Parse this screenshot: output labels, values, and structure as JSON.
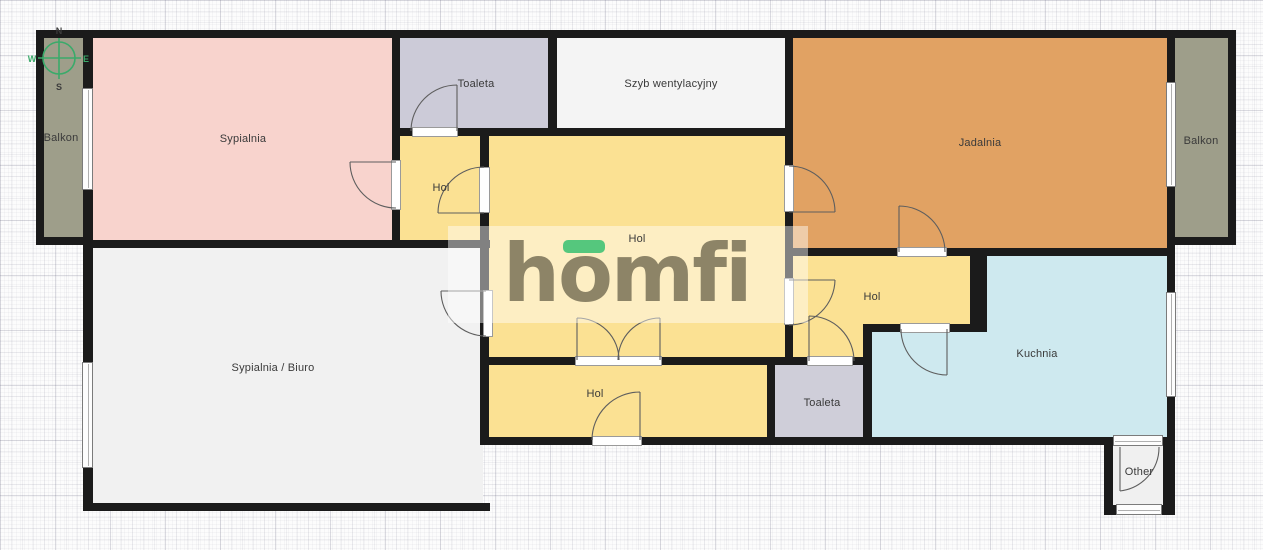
{
  "brand": {
    "logo_text": "homfi",
    "logo_color": "#8d8467",
    "accent_green": "#55c77d"
  },
  "compass": {
    "n": "N",
    "s": "S",
    "w": "W",
    "e": "E",
    "ring_color": "#3aaa6a",
    "ns_color": "#3c3c3c",
    "we_color": "#3aaa6a"
  },
  "rooms": {
    "balkon_left": {
      "label": "Balkon",
      "color": "#9e9e8a"
    },
    "sypialnia": {
      "label": "Sypialnia",
      "color": "#f8d3cd"
    },
    "toaleta_top": {
      "label": "Toaleta",
      "color": "#cccbd8"
    },
    "szyb": {
      "label": "Szyb wentylacyjny",
      "color": "#f4f4f4"
    },
    "jadalnia": {
      "label": "Jadalnia",
      "color": "#e1a263"
    },
    "balkon_right": {
      "label": "Balkon",
      "color": "#9e9e8a"
    },
    "hol_small": {
      "label": "Hol",
      "color": "#fbe193"
    },
    "hol_main": {
      "label": "Hol",
      "color": "#fbe193"
    },
    "hol_right": {
      "label": "Hol",
      "color": "#fbe193"
    },
    "hol_bottom": {
      "label": "Hol",
      "color": "#fbe193"
    },
    "sypialnia_biuro": {
      "label": "Sypialnia / Biuro",
      "color": "#f1f1f1"
    },
    "kuchnia": {
      "label": "Kuchnia",
      "color": "#cee9ef"
    },
    "toaleta_bottom": {
      "label": "Toaleta",
      "color": "#cfced9"
    },
    "other": {
      "label": "Other",
      "color": "#f0f0f0"
    }
  },
  "wall_color": "#1b1b1b"
}
